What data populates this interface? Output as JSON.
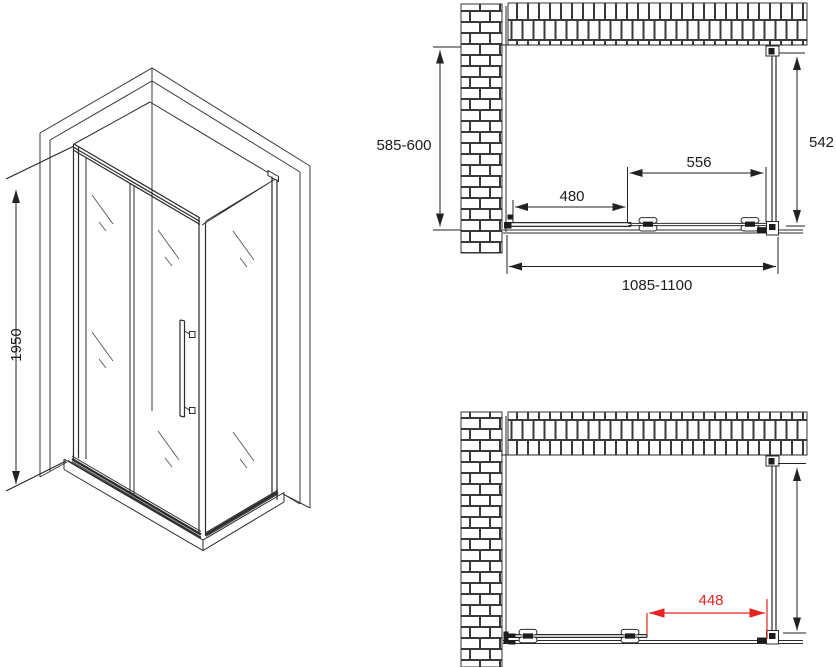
{
  "drawing": {
    "colors": {
      "background": "#ffffff",
      "line": "#2b2b2b",
      "dimension_red": "#e52421"
    },
    "views": {
      "perspective": {
        "dimensions": {
          "height": "1950"
        }
      },
      "plan_closed": {
        "dimensions": {
          "depth_range": "585-600",
          "side_panel": "542",
          "sliding_door": "556",
          "fixed_panel": "480",
          "overall_width_range": "1085-1100"
        }
      },
      "plan_open": {
        "dimensions": {
          "clear_opening": "448"
        }
      }
    }
  }
}
